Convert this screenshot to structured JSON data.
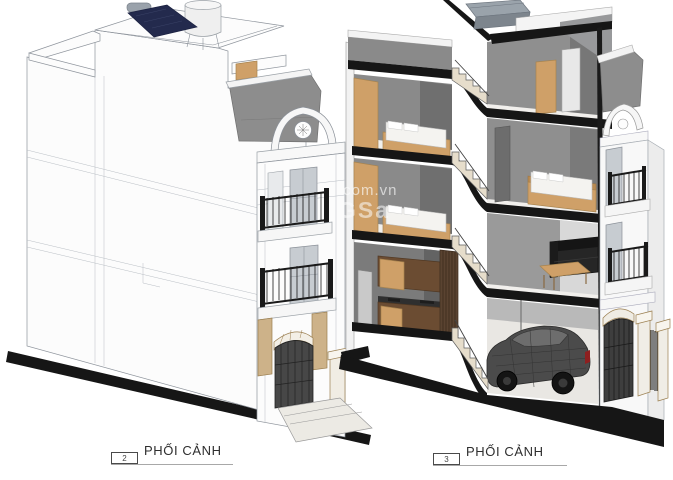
{
  "sheet": {
    "background": "#ffffff"
  },
  "views": [
    {
      "name": "exterior-perspective",
      "tag_number": "2",
      "title": "PHỐI CẢNH"
    },
    {
      "name": "cutaway-section-perspective",
      "tag_number": "3",
      "title": "PHỐI CẢNH"
    }
  ],
  "watermark": {
    "line1": ".com.vn",
    "line2": "GSa"
  },
  "colors": {
    "slab_black": "#161616",
    "wall_gray": "#8a8a8a",
    "wall_dark": "#6f6f6f",
    "roof_gray": "#8d8d8d",
    "line_gray": "#8e949c",
    "wood_tan": "#cfa068",
    "wood_brown": "#6b4c32",
    "wood_dark": "#5a4331",
    "facade_tan": "#cdb289",
    "solar_navy": "#232a4d",
    "glass_gray": "#c7ccd1",
    "car_gray": "#4b4b4b",
    "accent_red": "#8e1f1f",
    "mattress_white": "#f4f3f0",
    "railing_black": "#1a1a1a"
  }
}
